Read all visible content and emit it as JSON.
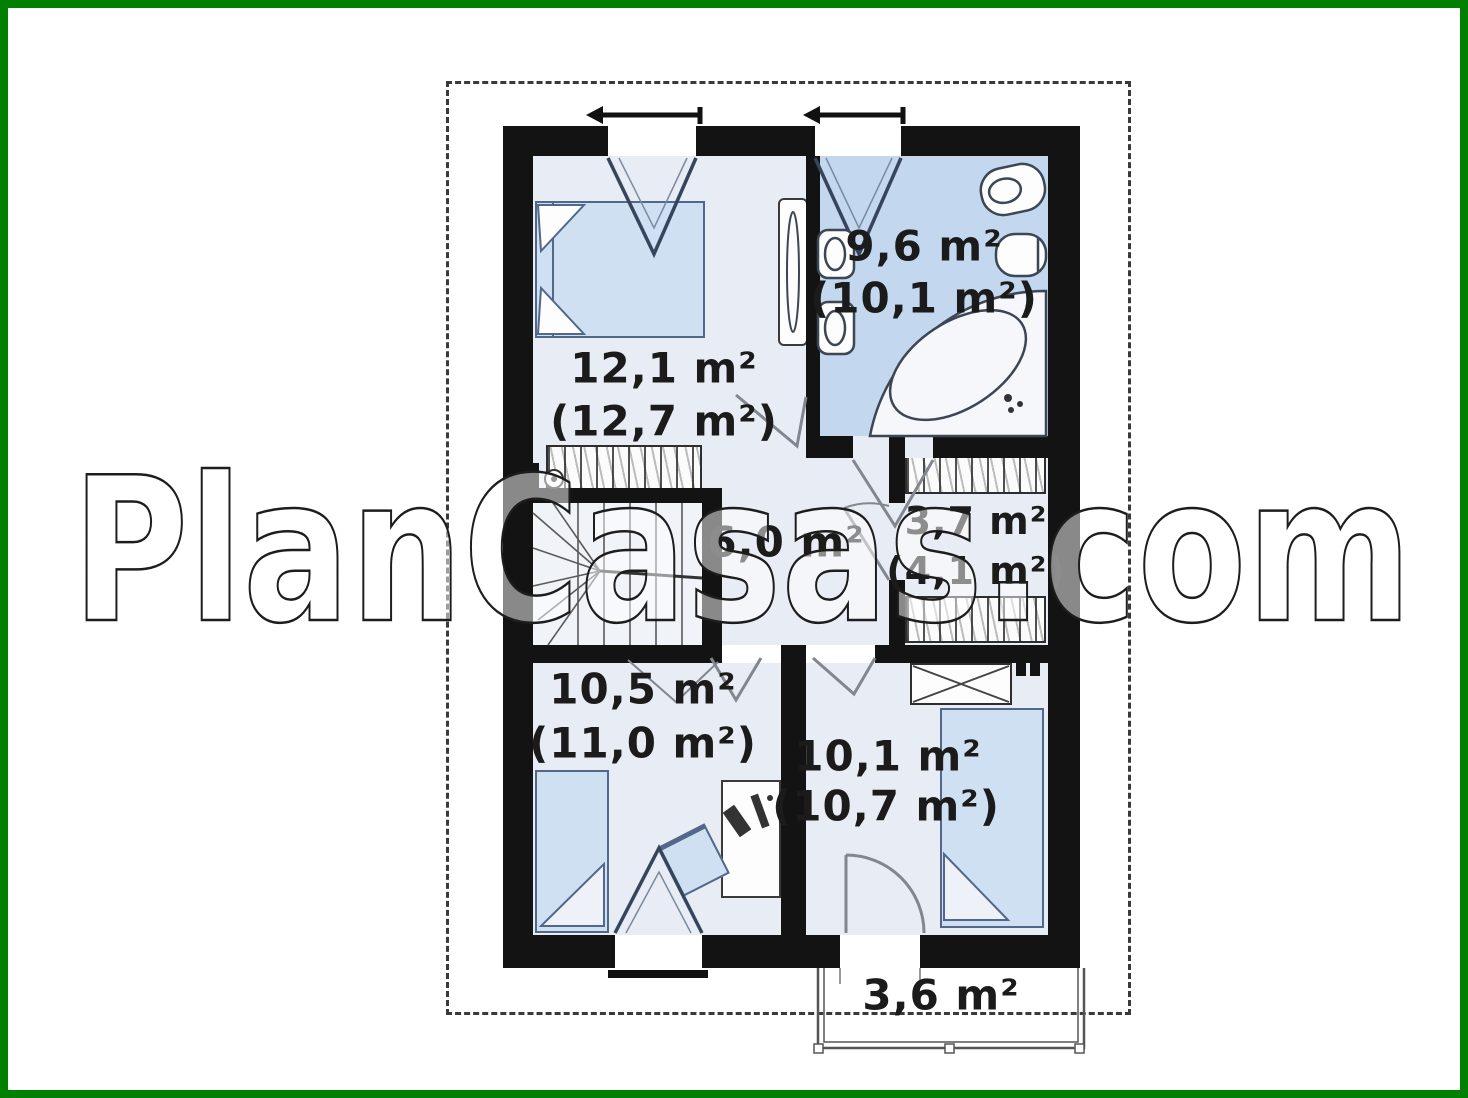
{
  "watermark": "PlanCasas.com",
  "rooms": {
    "bedroom_top": {
      "name": "bedroom-top",
      "area": "12,1 m²",
      "area_gross": "(12,7 m²)"
    },
    "bathroom": {
      "name": "bathroom",
      "area": "9,6 m²",
      "area_gross": "(10,1 m²)"
    },
    "closet": {
      "name": "closet",
      "area": "3,7 m²",
      "area_gross": "(4,1 m²)"
    },
    "hall": {
      "name": "hall",
      "area": "6,0 m²"
    },
    "bedroom_left": {
      "name": "bedroom-left",
      "area": "10,5 m²",
      "area_gross": "(11,0 m²)"
    },
    "bedroom_right": {
      "name": "bedroom-right",
      "area": "10,1 m²",
      "area_gross": "(10,7 m²)"
    },
    "balcony": {
      "name": "balcony",
      "area": "3,6 m²"
    }
  },
  "colors": {
    "frame": "#008000",
    "wall": "#131313",
    "room_fill": "#e8ecf4",
    "bathroom_fill": "#c3d7ee",
    "furniture_fill": "#cfe0f3",
    "roof_outline": "#3a3a3a"
  }
}
